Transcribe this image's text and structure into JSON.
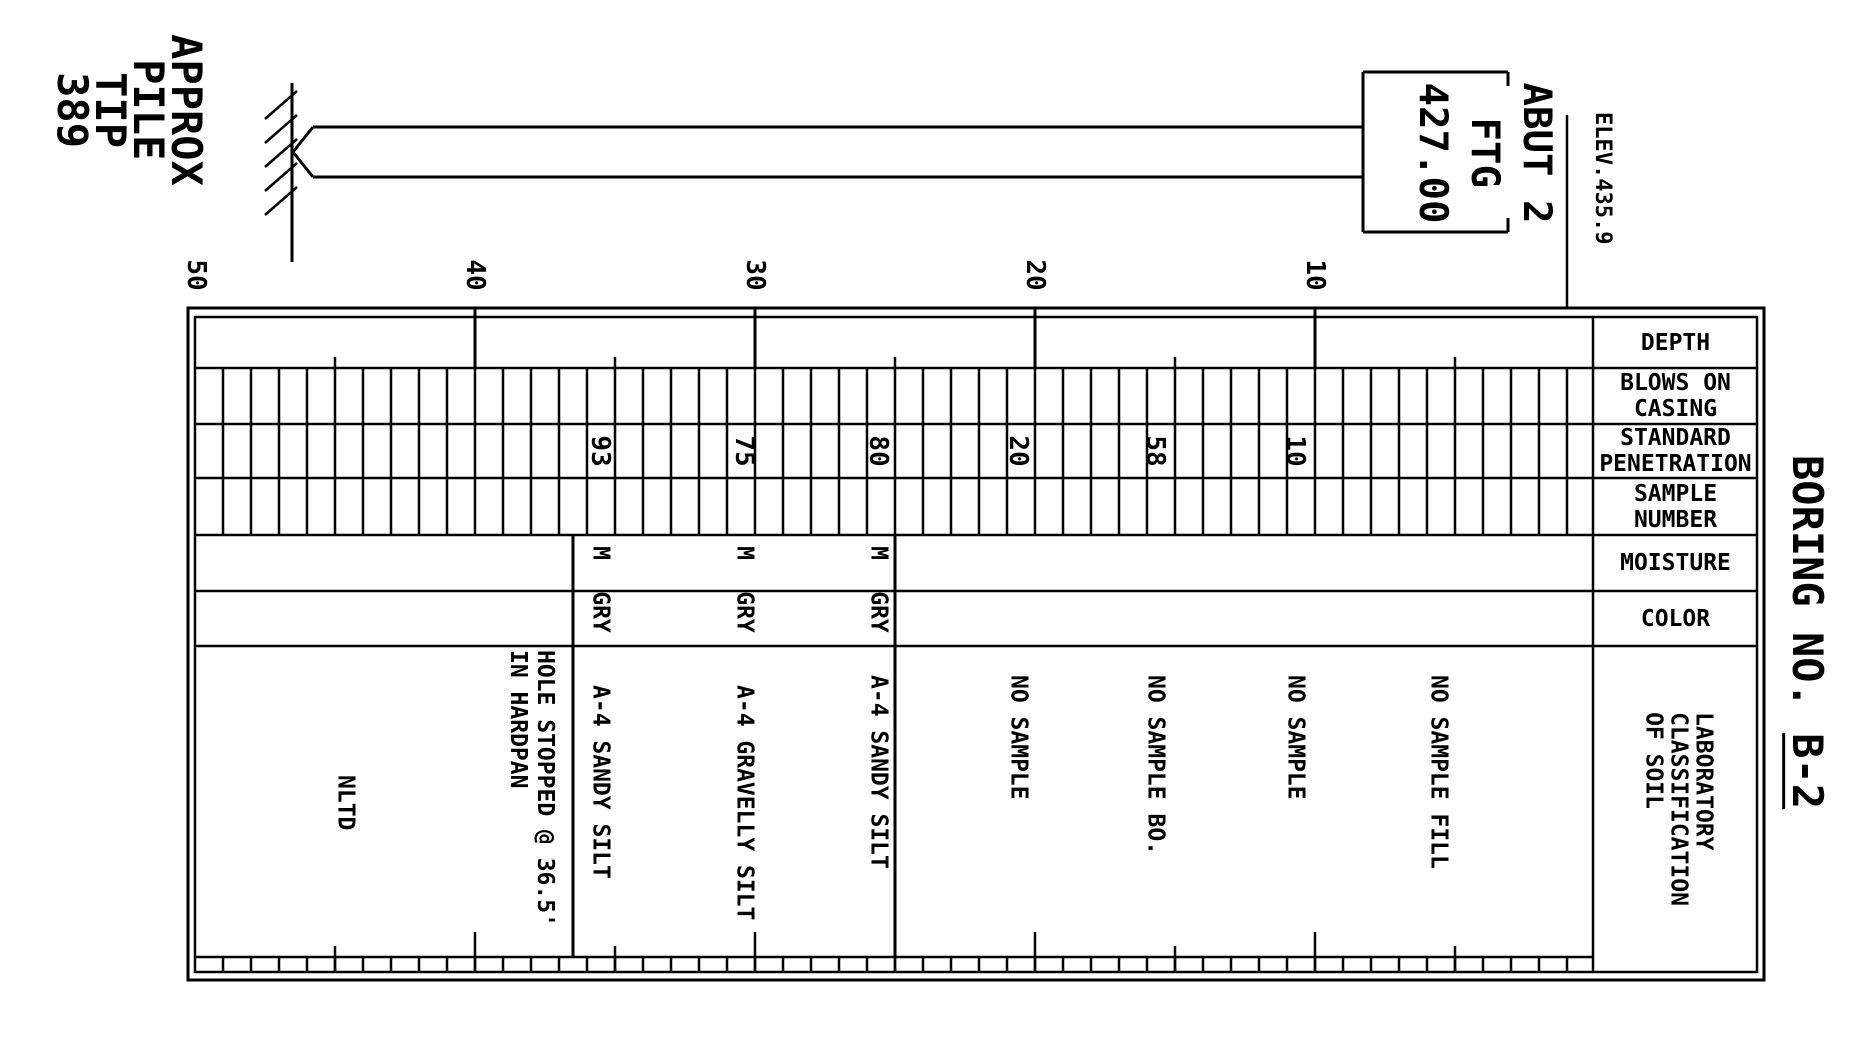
{
  "title": {
    "prefix": "BORING NO. ",
    "number": "B-2"
  },
  "annotations": {
    "pile_note": "APPROX\nPILE\nTIP\n389",
    "footing_label": "ABUT 2\nFTG\n427.00",
    "ground_elevation": "ELEV.435.9"
  },
  "table": {
    "headers": [
      "DEPTH",
      "BLOWS ON\nCASING",
      "STANDARD\nPENETRATION",
      "SAMPLE\nNUMBER",
      "MOISTURE",
      "COLOR",
      "LABORATORY\nCLASSIFICATION\nOF SOIL"
    ],
    "depth_scale_labels": [
      "50",
      "40",
      "30",
      "20",
      "10"
    ]
  },
  "log": {
    "samples": [
      {
        "standard_penetration": "93",
        "moisture": "M",
        "color": "GRY"
      },
      {
        "standard_penetration": "75",
        "moisture": "M",
        "color": "GRY"
      },
      {
        "standard_penetration": "80",
        "moisture": "M",
        "color": "GRY"
      },
      {
        "standard_penetration": "20",
        "moisture": "",
        "color": ""
      },
      {
        "standard_penetration": "58",
        "moisture": "",
        "color": ""
      },
      {
        "standard_penetration": "10",
        "moisture": "",
        "color": ""
      }
    ],
    "classifications": [
      "NLTD",
      "HOLE STOPPED @ 36.5'\nIN HARDPAN",
      "A-4 SANDY SILT",
      "A-4 GRAVELLY SILT",
      "A-4 SANDY SILT",
      "NO SAMPLE",
      "NO SAMPLE BO.",
      "NO SAMPLE",
      "NO SAMPLE FILL"
    ]
  },
  "colors": {
    "ink": "#000000",
    "paper": "#ffffff"
  }
}
